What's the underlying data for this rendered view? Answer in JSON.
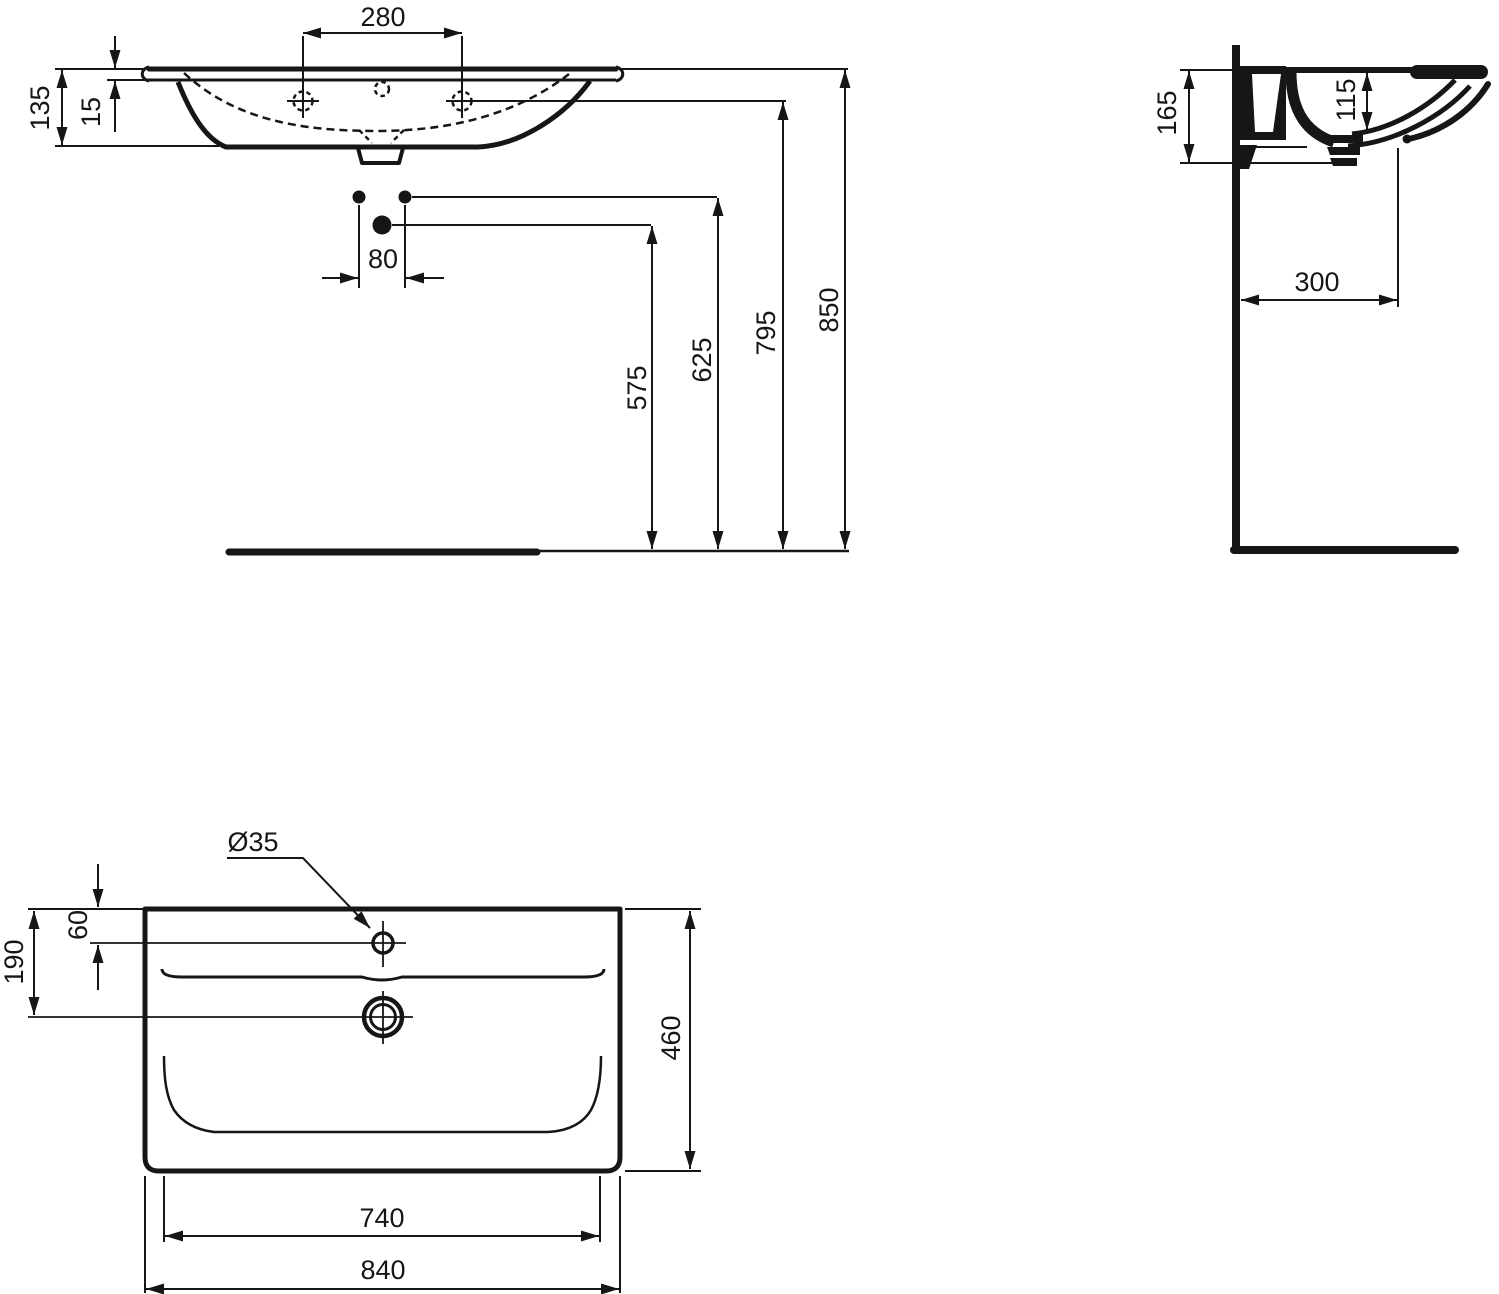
{
  "front_view": {
    "tap_hole_spacing": "280",
    "basin_height": "135",
    "rim_thickness": "15",
    "bolt_hole_spacing": "80",
    "trap_outlet_height": "575",
    "bolt_hole_height": "625",
    "tap_hole_height": "795",
    "rim_top_height": "850"
  },
  "side_view": {
    "front_edge_height": "165",
    "basin_inner_depth": "115",
    "wall_to_outlet": "300"
  },
  "top_view": {
    "tap_hole_diameter": "Ø35",
    "tap_hole_from_back": "60",
    "drain_from_back": "190",
    "basin_depth": "460",
    "inner_width": "740",
    "overall_width": "840"
  }
}
